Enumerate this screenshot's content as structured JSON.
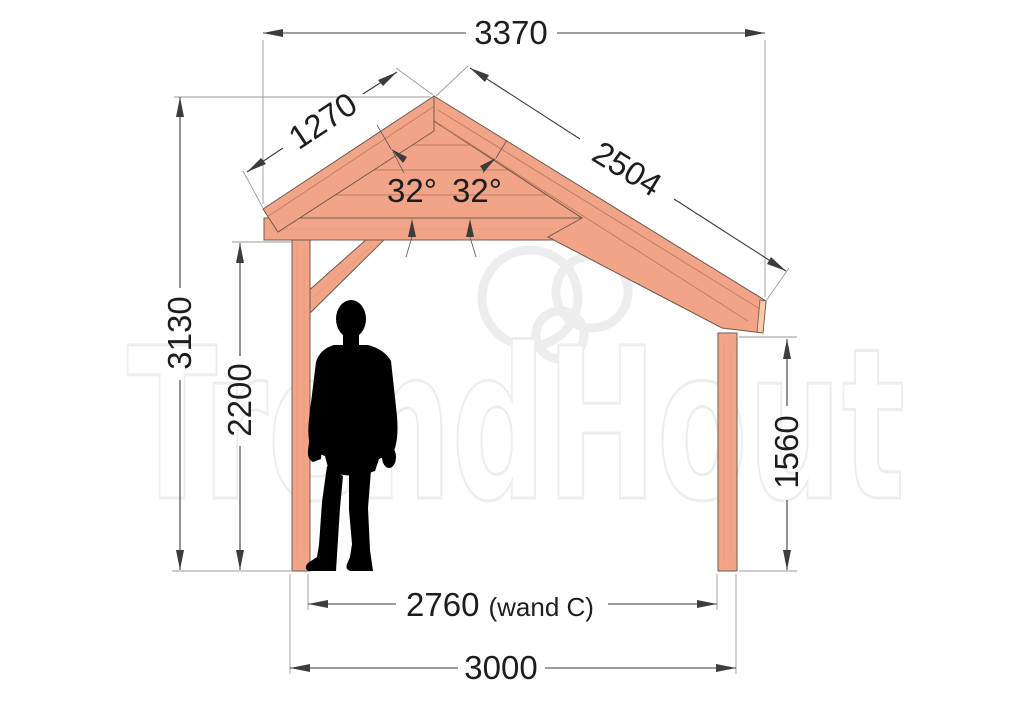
{
  "watermark": {
    "text": "TrendHout"
  },
  "dimensions": {
    "roof_total_width": "3370",
    "left_slope_length": "1270",
    "right_slope_length": "2504",
    "left_roof_angle": "32°",
    "right_roof_angle": "32°",
    "total_height": "3130",
    "left_clear_height": "2200",
    "right_post_height": "1560",
    "inner_span_value": "2760",
    "inner_span_note": "(wand C)",
    "outer_span": "3000"
  },
  "colors": {
    "wood_main": "#f2a488",
    "wood_light": "#f8cbaa",
    "wood_outline": "#6f5b4c",
    "wood_seam": "#bf7d5e",
    "wood_grain": "#e6986f",
    "dim_line": "#3c3c3c",
    "ext_line": "#9a9a9a",
    "dim_text": "#1d1d1d",
    "silhouette": "#000000",
    "watermark": "#ededed"
  }
}
